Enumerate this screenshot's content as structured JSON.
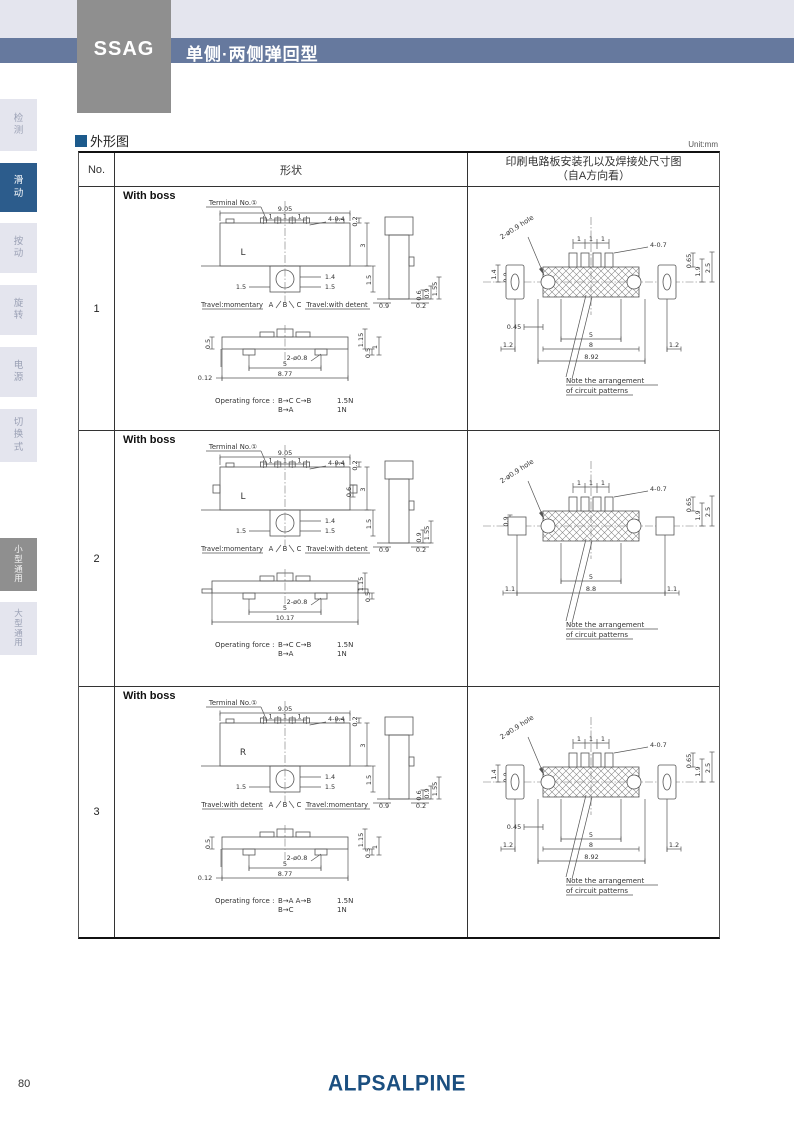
{
  "header": {
    "series": "SSAG",
    "subtitle": "单侧·两侧弹回型"
  },
  "sidebar": {
    "items": [
      {
        "label": "检测",
        "state": "normal"
      },
      {
        "label": "滑动",
        "state": "active"
      },
      {
        "label": "按动",
        "state": "normal"
      },
      {
        "label": "旋转",
        "state": "normal"
      },
      {
        "label": "电源",
        "state": "normal"
      },
      {
        "label": "切换式",
        "state": "normal"
      },
      {
        "label": "小型通用",
        "state": "grey"
      },
      {
        "label": "大型通用",
        "state": "normal"
      }
    ]
  },
  "section": {
    "title": "外形图",
    "unit": "Unit:mm"
  },
  "table": {
    "headers": {
      "no": "No.",
      "shape": "形状",
      "pcb_line1": "印刷电路板安装孔以及焊接处尺寸图",
      "pcb_line2": "（自A方向看）"
    },
    "rows": [
      {
        "no": "1",
        "variant": 1,
        "boss_label": "With boss",
        "terminal_label": "Terminal No.①",
        "mark": "L",
        "top": {
          "overall": "9.05",
          "pitch": [
            "1",
            "1",
            "1"
          ],
          "slot": "4-0.4",
          "off": "0.2",
          "height": "3",
          "extra": "",
          "knob": "1.4",
          "knob_l": "1.5",
          "knob_r": "1.5",
          "boss_h": "1.5"
        },
        "side": {
          "bl": "0.9",
          "br": "0.2",
          "right": [
            "0.6",
            "0.9",
            "1.55"
          ]
        },
        "bottom": {
          "left": "0.5",
          "top_r": "1.15",
          "r1": "1",
          "r2": "0.5",
          "hole": "2-ø0.8",
          "span": "5",
          "overall": "8.77",
          "offset": "0.12"
        },
        "travel": {
          "left": "Travel:momentary",
          "letters": [
            "A",
            "B",
            "C"
          ],
          "right": "Travel:with detent"
        },
        "force": {
          "label": "Operating force :",
          "rows": [
            [
              "B→C C→B",
              "1.5N"
            ],
            [
              "B→A",
              "1N"
            ]
          ]
        },
        "pcb": {
          "hole": "2-ø0.9 hole",
          "pitch": [
            "1",
            "1",
            "1"
          ],
          "pad": "4-0.7",
          "top": "0.65",
          "left": [
            "1.4",
            "0.9"
          ],
          "right": [
            "1.9",
            "2.5"
          ],
          "b_gap": "0.45",
          "b_out_l": "1.2",
          "span": "5",
          "mid": "8",
          "b_out_r": "1.2",
          "overall": "8.92",
          "note": [
            "Note the arrangement",
            "of circuit patterns"
          ]
        }
      },
      {
        "no": "2",
        "variant": 2,
        "boss_label": "With boss",
        "terminal_label": "Terminal No.①",
        "mark": "L",
        "top": {
          "overall": "9.05",
          "pitch": [
            "1",
            "1",
            "1"
          ],
          "slot": "4-0.4",
          "off": "0.2",
          "height": "3",
          "extra": "0.6",
          "knob": "1.4",
          "knob_l": "1.5",
          "knob_r": "1.5",
          "boss_h": "1.5"
        },
        "side": {
          "bl": "0.9",
          "br": "0.2",
          "right": [
            "0.9",
            "1.55"
          ]
        },
        "bottom": {
          "left": "",
          "top_r": "1.15",
          "r1": "",
          "r2": "0.5",
          "hole": "2-ø0.8",
          "span": "5",
          "overall": "10.17",
          "offset": ""
        },
        "travel": {
          "left": "Travel:momentary",
          "letters": [
            "A",
            "B",
            "C"
          ],
          "right": "Travel:with detent"
        },
        "force": {
          "label": "Operating force :",
          "rows": [
            [
              "B→C C→B",
              "1.5N"
            ],
            [
              "B→A",
              "1N"
            ]
          ]
        },
        "pcb": {
          "hole": "2-ø0.9 hole",
          "pitch": [
            "1",
            "1",
            "1"
          ],
          "pad": "4-0.7",
          "top": "0.65",
          "left": [
            "0.9"
          ],
          "right": [
            "1.9",
            "2.5"
          ],
          "b_gap": "",
          "b_out_l": "1.1",
          "span": "5",
          "mid": "8.8",
          "b_out_r": "1.1",
          "overall": "",
          "note": [
            "Note the arrangement",
            "of circuit patterns"
          ]
        }
      },
      {
        "no": "3",
        "variant": 3,
        "boss_label": "With boss",
        "terminal_label": "Terminal No.①",
        "mark": "R",
        "top": {
          "overall": "9.05",
          "pitch": [
            "1",
            "1",
            "1"
          ],
          "slot": "4-0.4",
          "off": "0.2",
          "height": "3",
          "extra": "",
          "knob": "1.4",
          "knob_l": "1.5",
          "knob_r": "1.5",
          "boss_h": "1.5"
        },
        "side": {
          "bl": "0.9",
          "br": "0.2",
          "right": [
            "0.6",
            "0.9",
            "1.55"
          ]
        },
        "bottom": {
          "left": "0.5",
          "top_r": "1.15",
          "r1": "1",
          "r2": "0.5",
          "hole": "2-ø0.8",
          "span": "5",
          "overall": "8.77",
          "offset": "0.12"
        },
        "travel": {
          "left": "Travel:with detent",
          "letters": [
            "A",
            "B",
            "C"
          ],
          "right": "Travel:momentary"
        },
        "force": {
          "label": "Operating force :",
          "rows": [
            [
              "B→A A→B",
              "1.5N"
            ],
            [
              "B→C",
              "1N"
            ]
          ]
        },
        "pcb": {
          "hole": "2-ø0.9 hole",
          "pitch": [
            "1",
            "1",
            "1"
          ],
          "pad": "4-0.7",
          "top": "0.65",
          "left": [
            "1.4",
            "0.9"
          ],
          "right": [
            "1.9",
            "2.5"
          ],
          "b_gap": "0.45",
          "b_out_l": "1.2",
          "span": "5",
          "mid": "8",
          "b_out_r": "1.2",
          "overall": "8.92",
          "note": [
            "Note the arrangement",
            "of circuit patterns"
          ]
        }
      }
    ]
  },
  "footer": {
    "page": "80",
    "logo": "ALPSALPINE"
  },
  "colors": {
    "band": "#e4e5ee",
    "bar": "#66799e",
    "series_box": "#8f8f8f",
    "active_tab": "#2c5c8c",
    "grey_tab": "#8f8f8f",
    "accent": "#1c5a8c",
    "logo": "#1b4f80"
  }
}
